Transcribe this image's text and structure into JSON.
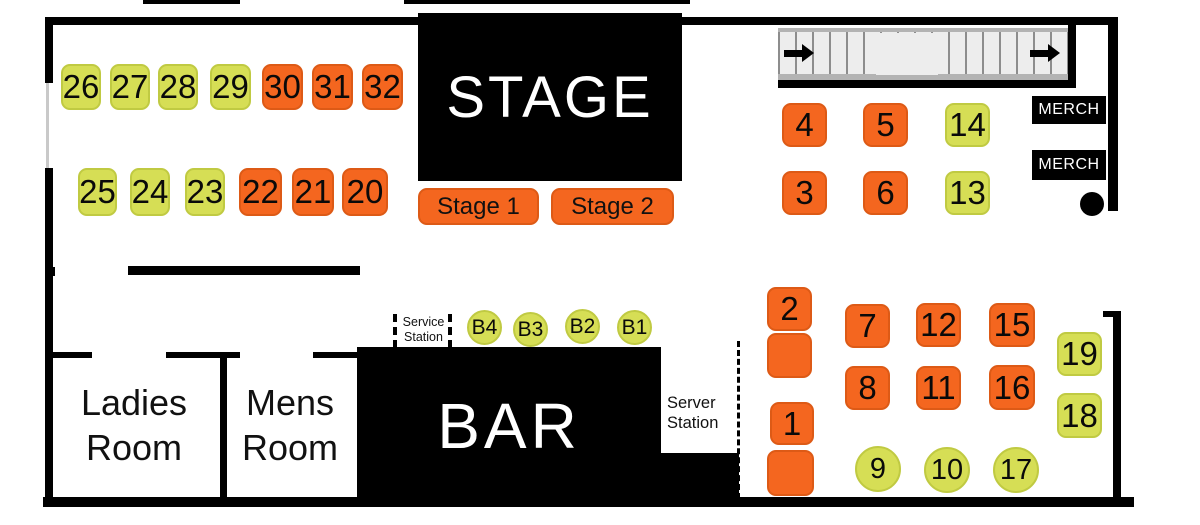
{
  "colors": {
    "orange": "#F4661F",
    "orange_border": "#DD5A16",
    "green": "#D6DE55",
    "green_border": "#C0CA42"
  },
  "labels": {
    "stage": "STAGE",
    "stage_1": "Stage 1",
    "stage_2": "Stage 2",
    "bar": "BAR",
    "ladies_room": "Ladies Room",
    "mens_room": "Mens Room",
    "service_station": "Service Station",
    "server_station": "Server Station",
    "merch_upper": "MERCH",
    "merch_lower": "MERCH"
  },
  "tables": [
    {
      "label": "26",
      "shape": "square",
      "color": "green",
      "x": 61,
      "y": 64,
      "w": 40,
      "h": 46
    },
    {
      "label": "27",
      "shape": "square",
      "color": "green",
      "x": 110,
      "y": 64,
      "w": 40,
      "h": 46
    },
    {
      "label": "28",
      "shape": "square",
      "color": "green",
      "x": 158,
      "y": 64,
      "w": 40,
      "h": 46
    },
    {
      "label": "29",
      "shape": "square",
      "color": "green",
      "x": 210,
      "y": 64,
      "w": 41,
      "h": 46
    },
    {
      "label": "30",
      "shape": "square",
      "color": "orange",
      "x": 262,
      "y": 64,
      "w": 41,
      "h": 46
    },
    {
      "label": "31",
      "shape": "square",
      "color": "orange",
      "x": 312,
      "y": 64,
      "w": 41,
      "h": 46
    },
    {
      "label": "32",
      "shape": "square",
      "color": "orange",
      "x": 362,
      "y": 64,
      "w": 41,
      "h": 46
    },
    {
      "label": "25",
      "shape": "square",
      "color": "green",
      "x": 78,
      "y": 168,
      "w": 39,
      "h": 48
    },
    {
      "label": "24",
      "shape": "square",
      "color": "green",
      "x": 130,
      "y": 168,
      "w": 40,
      "h": 48
    },
    {
      "label": "23",
      "shape": "square",
      "color": "green",
      "x": 185,
      "y": 168,
      "w": 40,
      "h": 48
    },
    {
      "label": "22",
      "shape": "square",
      "color": "orange",
      "x": 239,
      "y": 168,
      "w": 43,
      "h": 48
    },
    {
      "label": "21",
      "shape": "square",
      "color": "orange",
      "x": 292,
      "y": 168,
      "w": 42,
      "h": 48
    },
    {
      "label": "20",
      "shape": "square",
      "color": "orange",
      "x": 342,
      "y": 168,
      "w": 46,
      "h": 48
    },
    {
      "label": "4",
      "shape": "square",
      "color": "orange",
      "x": 782,
      "y": 103,
      "w": 45,
      "h": 44
    },
    {
      "label": "5",
      "shape": "square",
      "color": "orange",
      "x": 863,
      "y": 103,
      "w": 45,
      "h": 44
    },
    {
      "label": "14",
      "shape": "square",
      "color": "green",
      "x": 945,
      "y": 103,
      "w": 45,
      "h": 44
    },
    {
      "label": "3",
      "shape": "square",
      "color": "orange",
      "x": 782,
      "y": 171,
      "w": 45,
      "h": 44
    },
    {
      "label": "6",
      "shape": "square",
      "color": "orange",
      "x": 863,
      "y": 171,
      "w": 45,
      "h": 44
    },
    {
      "label": "13",
      "shape": "square",
      "color": "green",
      "x": 945,
      "y": 171,
      "w": 45,
      "h": 44
    },
    {
      "label": "2",
      "shape": "square",
      "color": "orange",
      "x": 767,
      "y": 287,
      "w": 45,
      "h": 44
    },
    {
      "label": "",
      "shape": "square",
      "color": "orange",
      "x": 767,
      "y": 333,
      "w": 45,
      "h": 45
    },
    {
      "label": "7",
      "shape": "square",
      "color": "orange",
      "x": 845,
      "y": 304,
      "w": 45,
      "h": 44
    },
    {
      "label": "12",
      "shape": "square",
      "color": "orange",
      "x": 916,
      "y": 303,
      "w": 45,
      "h": 44
    },
    {
      "label": "15",
      "shape": "square",
      "color": "orange",
      "x": 989,
      "y": 303,
      "w": 46,
      "h": 44
    },
    {
      "label": "19",
      "shape": "square",
      "color": "green",
      "x": 1057,
      "y": 332,
      "w": 45,
      "h": 44
    },
    {
      "label": "8",
      "shape": "square",
      "color": "orange",
      "x": 845,
      "y": 366,
      "w": 45,
      "h": 44
    },
    {
      "label": "11",
      "shape": "square",
      "color": "orange",
      "x": 916,
      "y": 366,
      "w": 45,
      "h": 44
    },
    {
      "label": "16",
      "shape": "square",
      "color": "orange",
      "x": 989,
      "y": 365,
      "w": 46,
      "h": 45
    },
    {
      "label": "18",
      "shape": "square",
      "color": "green",
      "x": 1057,
      "y": 393,
      "w": 45,
      "h": 45
    },
    {
      "label": "1",
      "shape": "square",
      "color": "orange",
      "x": 770,
      "y": 402,
      "w": 44,
      "h": 43
    },
    {
      "label": "",
      "shape": "square",
      "color": "orange",
      "x": 767,
      "y": 450,
      "w": 47,
      "h": 46
    },
    {
      "label": "9",
      "shape": "circle",
      "color": "green",
      "x": 855,
      "y": 446,
      "w": 46,
      "h": 46
    },
    {
      "label": "10",
      "shape": "circle",
      "color": "green",
      "x": 924,
      "y": 447,
      "w": 46,
      "h": 46
    },
    {
      "label": "17",
      "shape": "circle",
      "color": "green",
      "x": 993,
      "y": 447,
      "w": 46,
      "h": 46
    },
    {
      "label": "B4",
      "shape": "circle-sm",
      "color": "green",
      "x": 467,
      "y": 310,
      "w": 35,
      "h": 35
    },
    {
      "label": "B3",
      "shape": "circle-sm",
      "color": "green",
      "x": 513,
      "y": 312,
      "w": 35,
      "h": 35
    },
    {
      "label": "B2",
      "shape": "circle-sm",
      "color": "green",
      "x": 565,
      "y": 309,
      "w": 35,
      "h": 35
    },
    {
      "label": "B1",
      "shape": "circle-sm",
      "color": "green",
      "x": 617,
      "y": 310,
      "w": 35,
      "h": 35
    }
  ]
}
